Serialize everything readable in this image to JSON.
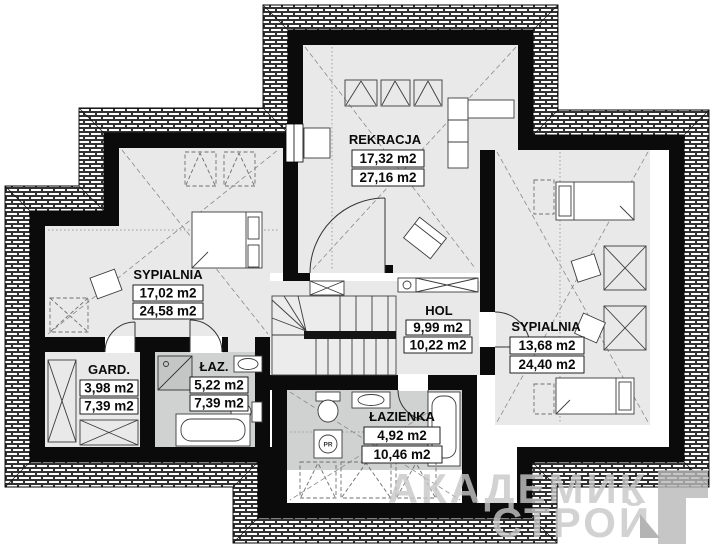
{
  "plan": {
    "rooms": [
      {
        "name": "REKRACJA",
        "area_floor": "17,32 m2",
        "area_total": "27,16 m2"
      },
      {
        "name": "SYPIALNIA",
        "area_floor": "17,02 m2",
        "area_total": "24,58 m2"
      },
      {
        "name": "GARD.",
        "area_floor": "3,98 m2",
        "area_total": "7,39 m2"
      },
      {
        "name": "ŁAZ.",
        "area_floor": "5,22 m2",
        "area_total": "7,39 m2"
      },
      {
        "name": "HOL",
        "area_floor": "9,99 m2",
        "area_total": "10,22 m2"
      },
      {
        "name": "SYPIALNIA",
        "area_floor": "13,68 m2",
        "area_total": "24,40 m2"
      },
      {
        "name": "ŁAZIENKA",
        "area_floor": "4,92 m2",
        "area_total": "10,46 m2"
      }
    ],
    "symbols": {
      "washing_machine": "PR"
    },
    "watermark": {
      "line1": "АКАДЕМИК",
      "line2": "СТРОЙ"
    },
    "colors": {
      "floor": "#e9e9e9",
      "bath_floor": "#d0d1d1",
      "wall": "#0b0b0b",
      "watermark": "#c7c7c7"
    }
  }
}
